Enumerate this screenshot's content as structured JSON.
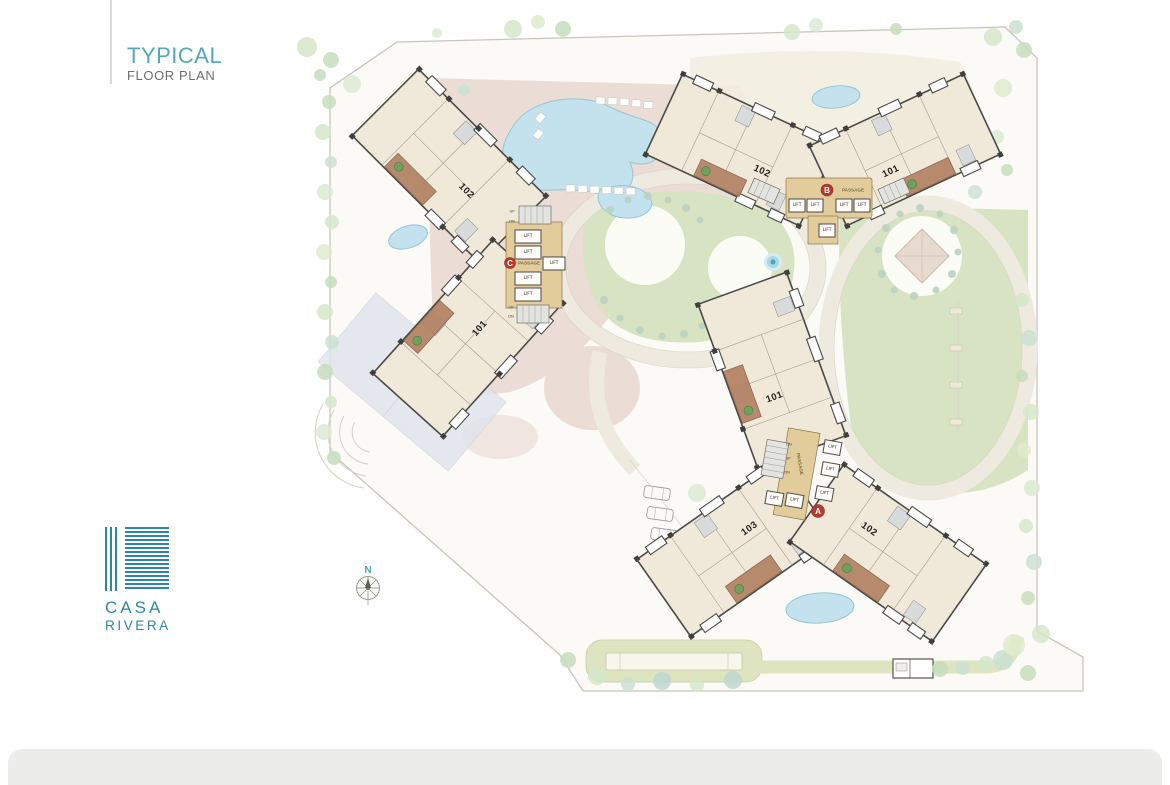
{
  "title": {
    "line1": "TYPICAL",
    "line2": "FLOOR PLAN"
  },
  "logo": {
    "word1": "CASA",
    "word2": "RIVERA"
  },
  "compass": {
    "north": "N"
  },
  "core_labels": {
    "lift": "LIFT",
    "passage": "PASSAGE",
    "up": "UP",
    "dn": "DN"
  },
  "buildings": {
    "a": {
      "letter": "A",
      "unit_top": "101",
      "unit_left": "103",
      "unit_right": "102"
    },
    "b": {
      "letter": "B",
      "unit_left": "102",
      "unit_right": "101"
    },
    "c": {
      "letter": "C",
      "unit_top": "102",
      "unit_bottom": "101"
    }
  },
  "colors": {
    "accent_teal": "#54a8b8",
    "logo_teal": "#2f87a3",
    "marker_red": "#b53b30",
    "pool_blue": "#c3e2ee",
    "lawn_green": "#d8e3c3",
    "deck_pink": "#ecdcd6",
    "core_tan": "#e3cc9c",
    "balcony_brown": "#b48468"
  }
}
